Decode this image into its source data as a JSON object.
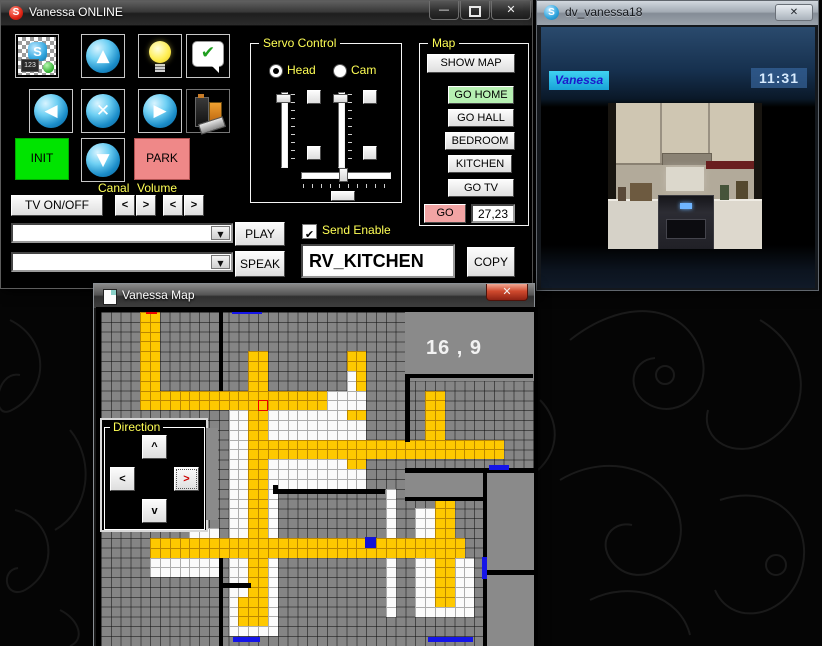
{
  "icons": {
    "up": "▲",
    "down": "▼",
    "left": "◀",
    "right": "▶",
    "stop": "✕",
    "check": "✔",
    "close": "✕",
    "minimize": "—",
    "dropdown": "▼",
    "skype_s": "S"
  },
  "main_window": {
    "title": "Vanessa ONLINE",
    "toolbar": [
      "video-call",
      "nav-up",
      "light",
      "confirm-speech",
      "nav-left",
      "stop",
      "nav-right",
      "battery"
    ],
    "buttons": {
      "init": "INIT",
      "park": "PARK",
      "tv": "TV ON/OFF",
      "play": "PLAY",
      "speak": "SPEAK",
      "copy": "COPY"
    },
    "labels": {
      "canal": "Canal",
      "volume": "Volume",
      "send_enable": "Send Enable"
    },
    "spin": {
      "left": "<",
      "right": ">"
    },
    "servo": {
      "title": "Servo Control",
      "head": "Head",
      "cam": "Cam"
    },
    "map_panel": {
      "title": "Map",
      "buttons": [
        "SHOW MAP",
        "GO HOME",
        "GO HALL",
        "BEDROOM",
        "KITCHEN",
        "GO TV"
      ],
      "go": "GO",
      "coords": "27,23"
    },
    "message_value": "RV_KITCHEN"
  },
  "skype_window": {
    "title": "dv_vanessa18",
    "caption": "Vanessa",
    "timestamp": "11:31"
  },
  "map_window": {
    "title": "Vanessa Map",
    "coord_label": "16 , 9",
    "direction": {
      "title": "Direction",
      "up": "^",
      "down": "v",
      "left": "<",
      "right": ">"
    },
    "grid": {
      "cols": 44,
      "rows": 34,
      "cell": 9.82,
      "legend": {
        "G": "#858585",
        "W": "#fbfbfb",
        "Y": "#fec900",
        "P": "#8a8a8a"
      },
      "rows_data": [
        "GGGGYYGGGGGGGGGGGGGGGGGGGGGGGGGPPPPPPPPPPPPP",
        "GGGGYYGGGGGGGGGGGGGGGGGGGGGGGGGPPPPPPPPPPPPP",
        "GGGGYYGGGGGGGGGGGGGGGGGGGGGGGGGPPPPPPPPPPPPP",
        "GGGGYYGGGGGGGGGGGGGGGGGGGGGGGGGPPPPPPPPPPPPP",
        "GGGGYYGGGGGGGGGYYGGGGGGGGYYGGGGPPPPPPPPPPPPP",
        "GGGGYYGGGGGGGGGYYGGGGGGGGYYGGGGPPPPPPPPPPPPP",
        "GGGGYYGGGGGGGGGYYGGGGGGGGWYGGGGPPPPPPPPPPPPP",
        "GGGGYYGGGGGGGGGYYGGGGGGGGWYGGGGGGGGGGGGGGGGG",
        "GGGGYYYYYYYYYYYYYYYYYYYWWWWGGGGGGYYGGGGGGGGG",
        "GGGGYYYYYYYYYYYYYYYYYYYWWWWGGGGGGYYGGGGGGGGG",
        "GGGGGGGGGGGGGWWYYWWWWWWWWYYGGGGGGYYGGGGGGGGG",
        "GGGGGGGGGGGGGWWYYWWWWWWWWWWGGGGGGYYGGGGGGGGG",
        "GGGGGGGGGGGGGWWYYWWWWWWWWWWGGGGGGYYGGGGGGGGG",
        "GGGGGGGGGGGGGWWYYYYYYYYYYYYYYYYYYYYYYYYYYGGG",
        "GGGGGGGGGGGGGWWYYYYYYYYYYYYYYYYYYYYYYYYYYGGG",
        "GGGGGGGGGGGGGWWYYWWWWWWWWYYGGGGGGGGGGGGGGGGG",
        "GGGGGGGGGGGGGWWYYWWWWWWWWWWGGGGPPPPPPPPPPPPP",
        "GGGGGGGGGGGGGWWYYWWWWWWWWWWGGGGPPPPPPPPPPPPP",
        "GGGGGGGGGGGGGWWYYWGGGGGGGGGGGWGPPPPPPPPPPPPP",
        "GGGGGGGGGGGGGWWYYWGGGGGGGGGGGWGGGGYYGGGPPPPP",
        "GGGGGGGGGGGGGWWYYWGGGGGGGGGGGWGGWWYYGGGPPPPP",
        "GGGGGGGGGGGGGWWYYWGGGGGGGGGGGWGGWWYYGGGPPPPP",
        "GGGGGGGGGWWWGWWYYWGGGGGGGGGGGWGGWWYYGGGPPPPP",
        "GGGGGYYYYYYYYYYYYYYYYYYYYYYYYYYYYYYYYGGPPPPP",
        "GGGGGYYYYYYYYYYYYYYYYYYYYYYYYYYYYYYYYGGPPPPP",
        "GGGGGWWWWWWWGWWYYWGGGGGGGGGGGWGGWWYYWWGPPPPP",
        "GGGGGWWWWWWWGWWYYWGGGGGGGGGGGWGGWWYYWWGPPPPP",
        "GGGGGGGGGGGGGWWYYWGGGGGGGGGGGWGGWWYYWWGPPPPP",
        "GGGGGGGGGGGGGWWYYWGGGGGGGGGGGWGGWWYYWWGPPPPP",
        "GGGGGGGGGGGGGWYYYWGGGGGGGGGGGWGGWWYYWWGPPPPP",
        "GGGGGGGGGGGGGWYYYWGGGGGGGGGGGWGGWWWWWWGPPPPP",
        "GGGGGGGGGGGGGWYYYWGGGGGGGGGGGGGGGGGGGGGPPPPP",
        "GGGGGGGGGGGGGWWWWWGGGGGGGGGGGGGGGGGGGGGPPPPP",
        "GGGGGGGGGGGGGGGGGGGGGGGGGGGGGGGGGGGGGGGPPPPP"
      ]
    },
    "walls": [
      [
        12,
        0,
        0.46,
        8
      ],
      [
        12,
        25,
        0.46,
        9.4
      ],
      [
        12,
        27.6,
        3.3,
        0.46
      ],
      [
        17.55,
        17.6,
        0.46,
        0.95
      ],
      [
        17.55,
        18.05,
        11.4,
        0.46
      ],
      [
        31,
        6.3,
        13,
        0.46
      ],
      [
        31,
        6.3,
        0.46,
        6.9
      ],
      [
        31,
        15.9,
        13.2,
        0.46
      ],
      [
        31,
        18.8,
        8.1,
        0.46
      ],
      [
        38.85,
        16,
        0.46,
        10.6
      ],
      [
        38.85,
        26.3,
        5.3,
        0.46
      ],
      [
        38.85,
        26.3,
        0.46,
        8.2
      ]
    ],
    "markers": [
      {
        "x": 4.55,
        "y": -0.25,
        "w": 1.15,
        "h": 0.5,
        "c": "#e80000"
      },
      {
        "x": 13.35,
        "y": -0.25,
        "w": 3.0,
        "h": 0.5,
        "c": "#1515e8"
      },
      {
        "x": 39.5,
        "y": 15.55,
        "w": 2.1,
        "h": 0.5,
        "c": "#1515e8"
      },
      {
        "x": 38.75,
        "y": 24.9,
        "w": 0.55,
        "h": 2.3,
        "c": "#1515e8"
      },
      {
        "x": 13.4,
        "y": 33.1,
        "w": 2.8,
        "h": 0.55,
        "c": "#1515e8"
      },
      {
        "x": 33.3,
        "y": 33.1,
        "w": 4.6,
        "h": 0.55,
        "c": "#1515e8"
      },
      {
        "x": 26.9,
        "y": 22.9,
        "w": 1.1,
        "h": 1.1,
        "c": "#1212d8"
      }
    ],
    "cursor": {
      "col": 16,
      "row": 9
    }
  }
}
